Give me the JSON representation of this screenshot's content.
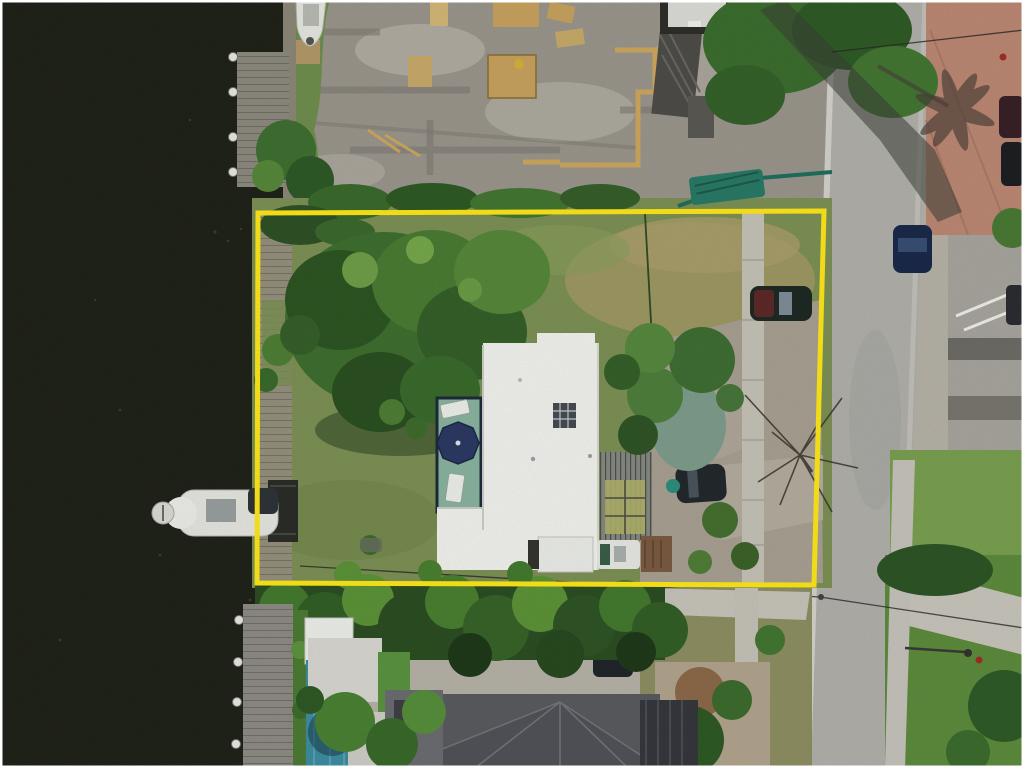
{
  "meta": {
    "type": "aerial-drone-photo",
    "description": "Overhead aerial photo of a waterfront residential lot outlined with a yellow property-boundary rectangle; canal water on the left, construction site above, street on the right, neighboring house and palms below.",
    "visible_text": ""
  },
  "annotation": {
    "shape": "rectangle",
    "purpose": "property-boundary",
    "coords_px": {
      "left": 258,
      "top": 211,
      "right": 824,
      "bottom": 584
    },
    "stroke_width_px": 5
  },
  "objects": [
    {
      "name": "water-canal",
      "desc": "dark canal water along left side"
    },
    {
      "name": "old-wooden-dock",
      "desc": "weathered plank dock with white pilings, top left"
    },
    {
      "name": "moored-white-boat",
      "desc": "small white boat at seawall, top left"
    },
    {
      "name": "boat-on-lift",
      "desc": "white boat on lift mid-left in canal"
    },
    {
      "name": "construction-site",
      "desc": "graded gray dirt lot with lumber and formwork, top center"
    },
    {
      "name": "construction-dumpster",
      "desc": "teal silt fence / covered bin at construction edge"
    },
    {
      "name": "subject-lot",
      "desc": "grassy lot inside yellow boundary with trees"
    },
    {
      "name": "main-house",
      "desc": "white flat-roof house in center of lot"
    },
    {
      "name": "patio-deck",
      "desc": "teal deck with navy umbrella and loungers left of house"
    },
    {
      "name": "pergola",
      "desc": "slatted pergola attached to right side of house"
    },
    {
      "name": "suv",
      "desc": "dark SUV parked on lot driveway"
    },
    {
      "name": "parked-car-in-lot",
      "desc": "dark car with maroon hood near right boundary"
    },
    {
      "name": "street",
      "desc": "light gray residential street running vertically on right"
    },
    {
      "name": "street-parked-car",
      "desc": "dark blue car parked on street"
    },
    {
      "name": "brick-driveway",
      "desc": "terracotta brick parking area top right with dark cars"
    },
    {
      "name": "swimming-pool",
      "desc": "teal pool bottom left beside modern dock"
    },
    {
      "name": "neighbor-house",
      "desc": "dark gray hip roof house at bottom"
    },
    {
      "name": "palm-canopy",
      "desc": "dense palm tree band along bottom of lot"
    }
  ],
  "colors": {
    "water": "#20231a",
    "dirt": "#9b978d",
    "dirtLight": "#b7b3a8",
    "dirtDark": "#7f7c74",
    "asphalt": "#b2b1ac",
    "concrete": "#c9c6bd",
    "brick": "#bd8974",
    "lawn": "#7d9156",
    "lawnDry": "#a39a66",
    "lawnBright": "#5e8c3e",
    "vegDark": "#2c4f22",
    "vegMid": "#447a2f",
    "vegLight": "#6fa044",
    "roofWhite": "#f3f4f0",
    "roofNeighbor": "#595b60",
    "pool": "#3e8da2",
    "deckTeal": "#8ab5a0",
    "umbrella": "#2c3a63",
    "boundary": "#ffe81a",
    "dockWood": "#8e8b80",
    "lumber": "#c8a35f",
    "fenceTeal": "#1f6f5f",
    "carBlue": "#1b2a4a",
    "carMaroon": "#5e2a28"
  }
}
